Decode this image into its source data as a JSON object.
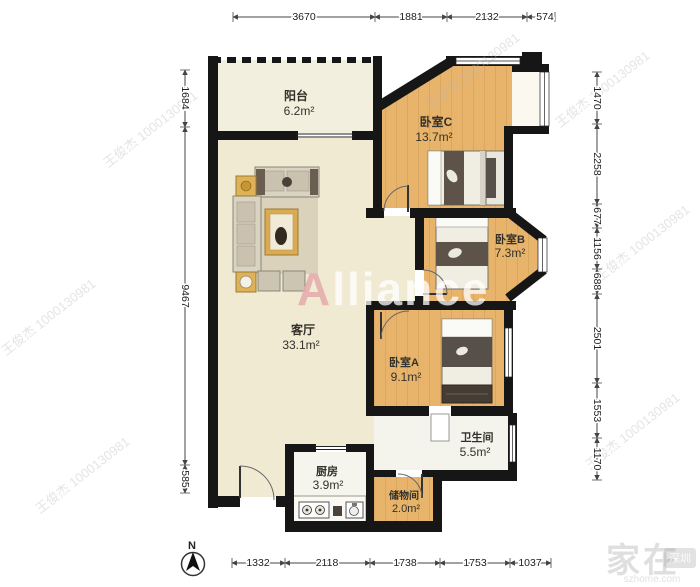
{
  "image_type": "real-estate floor plan",
  "compass": {
    "label": "N"
  },
  "watermarks": {
    "agent": "王俊杰 1000130981",
    "brand": "Alliance",
    "brand_initial": "A",
    "site_name": "家在",
    "site_city": "深圳",
    "site_url": "szhome.com"
  },
  "rooms": {
    "balcony": {
      "name": "阳台",
      "area": "6.2m²"
    },
    "bedroom_c": {
      "name": "卧室C",
      "area": "13.7m²"
    },
    "bedroom_b": {
      "name": "卧室B",
      "area": "7.3m²"
    },
    "bedroom_a": {
      "name": "卧室A",
      "area": "9.1m²"
    },
    "living_room": {
      "name": "客厅",
      "area": "33.1m²"
    },
    "bathroom": {
      "name": "卫生间",
      "area": "5.5m²"
    },
    "kitchen": {
      "name": "厨房",
      "area": "3.9m²"
    },
    "storage": {
      "name": "储物间",
      "area": "2.0m²"
    }
  },
  "dimensions_mm": {
    "top": [
      "3670",
      "1881",
      "2132",
      "574"
    ],
    "left": [
      "1684",
      "9467",
      "585"
    ],
    "right": [
      "1470",
      "2258",
      "677",
      "1156",
      "688",
      "2501",
      "1553",
      "1170"
    ],
    "bottom": [
      "1332",
      "2118",
      "1738",
      "1753",
      "1037"
    ]
  },
  "colors": {
    "wall": "#161616",
    "wood_floor": "#e8b46c",
    "living_floor": "#f0ead2",
    "wet_floor": "#f4f3ec",
    "dimension_text": "#222222"
  }
}
